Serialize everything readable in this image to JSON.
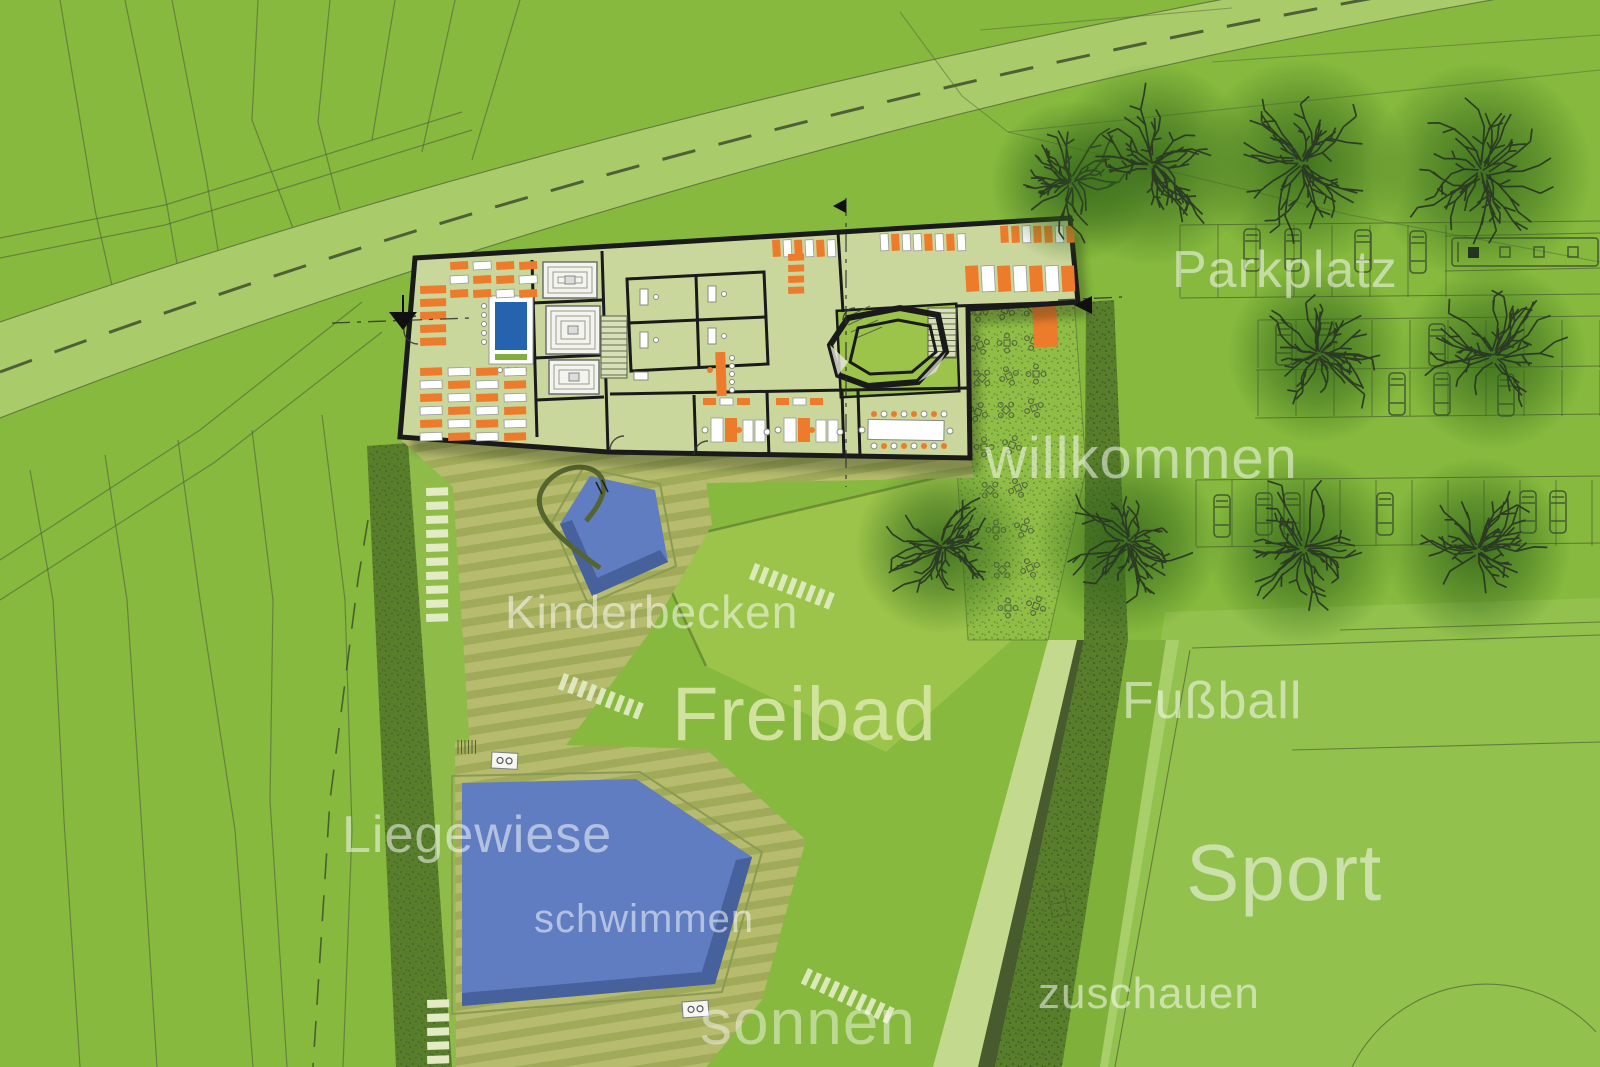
{
  "labels": {
    "parkplatz": "Parkplatz",
    "willkommen": "willkommen",
    "kinderbecken": "Kinderbecken",
    "freibad": "Freibad",
    "fussball": "Fußball",
    "liegewiese": "Liegewiese",
    "schwimmen": "schwimmen",
    "sport": "Sport",
    "sonnen": "sonnen",
    "zuschauen": "zuschauen"
  },
  "colors": {
    "bg": "#86B93D",
    "road": "#A9CB69",
    "roadDash": "#3E4E2E",
    "contour": "#55663F",
    "floor": "#C9D69C",
    "wall": "#1A1A1A",
    "orange": "#EC7C2C",
    "pool": "#5F7DC0",
    "poolDark": "#46619B",
    "deckA": "#B6BB6D",
    "deckB": "#A0AA59",
    "hedge": "#587E2C",
    "stipple": "#32461E",
    "walkway": "#8FBC49",
    "island": "#9CC44A",
    "field": "#92C14D",
    "medium": "#7FB03A",
    "lightPath": "#C3D98D",
    "terrace": "#8FBD46",
    "lounger": "#E2EBC4",
    "label": "rgba(255,255,255,0.52)",
    "freibadLabel": "#D5E5A3",
    "counterBlue": "#2563AE",
    "treeInk": "#2A3823",
    "treeGlow": "#33651A"
  }
}
